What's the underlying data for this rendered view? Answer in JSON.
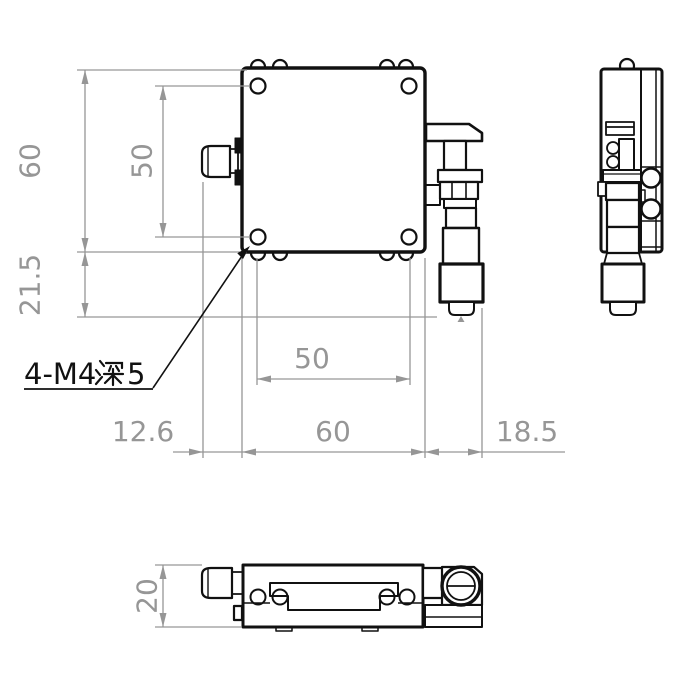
{
  "drawing": {
    "kind": "engineering-dimension-drawing",
    "part": "linear-translation-stage-with-micrometer",
    "views": {
      "front": "front-view",
      "side": "side-view",
      "bottom": "bottom-view"
    }
  },
  "dimensions": {
    "front_height": "60",
    "hole_pitch_vertical": "50",
    "micrometer_protrusion_bottom": "21.5",
    "hole_pitch_horizontal": "50",
    "knob_protrusion": "12.6",
    "body_width": "60",
    "micrometer_protrusion_side": "18.5",
    "stage_thickness": "20"
  },
  "annotation": {
    "full_text": "4-M4深5",
    "prefix": "4-M4",
    "cjk_char": "深",
    "suffix": "5"
  },
  "colors": {
    "outline": "#111111",
    "dimension": "#969696",
    "background": "#ffffff"
  }
}
